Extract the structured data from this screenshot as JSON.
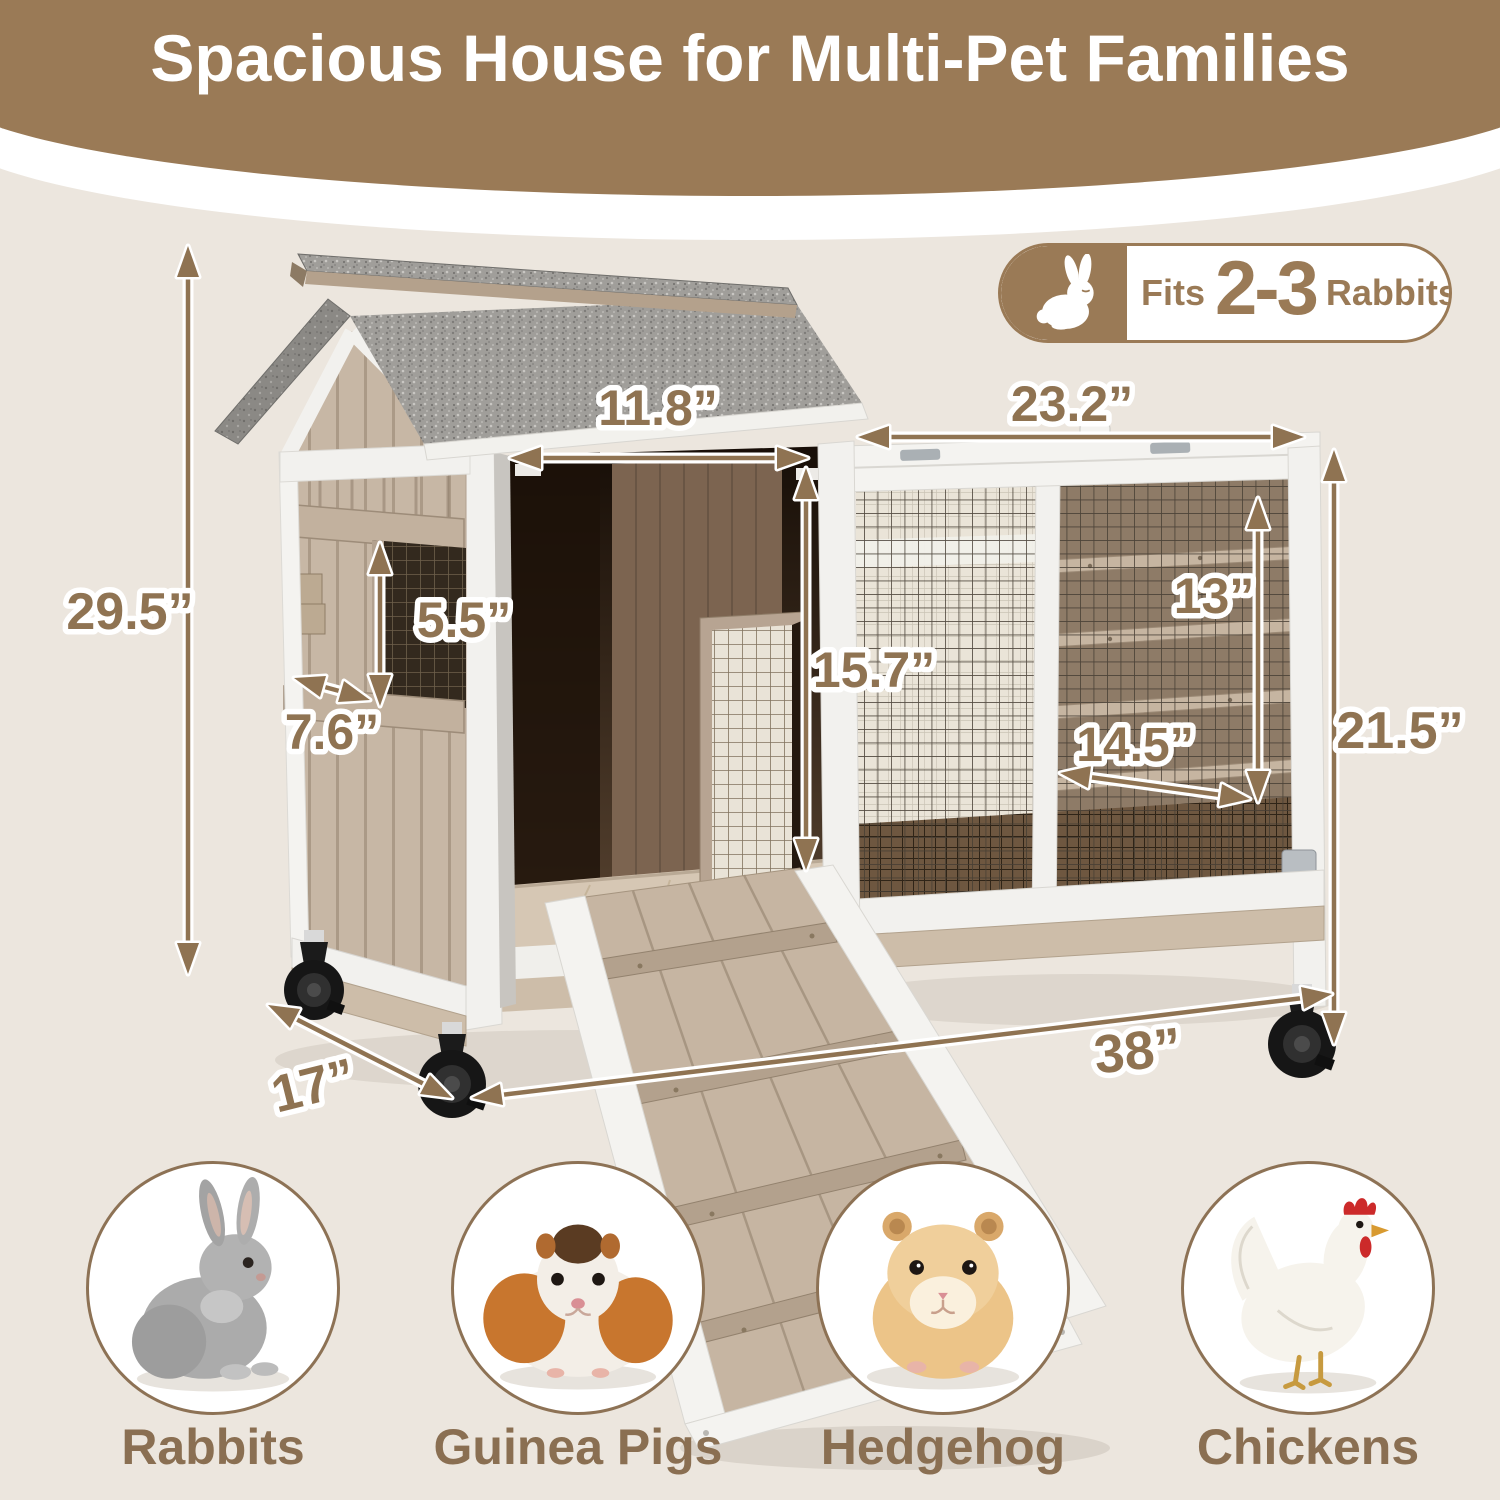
{
  "header": {
    "title": "Spacious House for Multi-Pet Families"
  },
  "badge": {
    "fits_label": "Fits",
    "count": "2-3",
    "animal_label": "Rabbits",
    "icon": "rabbit-icon"
  },
  "dims": {
    "overall_height": "29.5”",
    "door_width": "11.8”",
    "run_top_width": "23.2”",
    "window_height": "5.5”",
    "window_width": "7.6”",
    "door_height": "15.7”",
    "run_inner_height": "13”",
    "run_inner_width": "14.5”",
    "run_height": "21.5”",
    "depth": "17”",
    "overall_width": "38”"
  },
  "pets": [
    {
      "label": "Rabbits"
    },
    {
      "label": "Guinea Pigs"
    },
    {
      "label": "Hedgehog"
    },
    {
      "label": "Chickens"
    }
  ],
  "colors": {
    "brand_brown": "#9a7a56",
    "dimension_brown": "#8f7352",
    "pet_label_brown": "#8a6f52",
    "background_beige": "#ece6de",
    "roof_gray": "#a09e9a",
    "siding_tan": "#c7b7a5",
    "frame_white": "#f2f1ee"
  }
}
